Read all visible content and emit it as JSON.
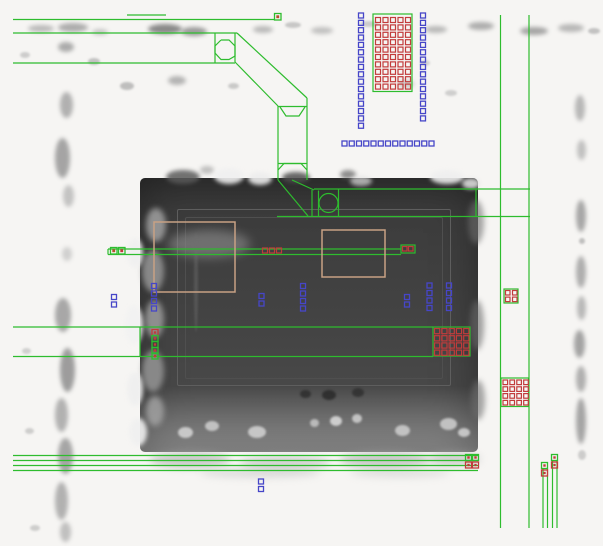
{
  "meta": {
    "description": "SEM micrograph of an IC region with CAD layout polygons overlaid (wires, contacts, vias, guide boxes)",
    "width": 603,
    "height": 546
  },
  "colors": {
    "background": "#f6f5f3",
    "wire_green": "#2ebc2e",
    "contact_blue": "#4646c8",
    "via_red": "#c23b3b",
    "marker_tan": "#c8a184",
    "marker_olive": "#9fae2f",
    "inner_red": "#b5512a",
    "sem_dark": "#3f3f3f"
  },
  "sem": {
    "dark_region": {
      "x": 140,
      "y": 178,
      "w": 338,
      "h": 274
    },
    "inner_rects": [
      {
        "x": 177,
        "y": 209,
        "w": 272,
        "h": 175,
        "c": "#5e5e5e"
      },
      {
        "x": 185,
        "y": 217,
        "w": 256,
        "h": 160,
        "c": "#4f4f4f"
      }
    ],
    "blobs": [
      [
        28,
        25,
        26,
        7,
        "#9a9a9a",
        2,
        0.65
      ],
      [
        58,
        23,
        30,
        9,
        "#8e8e8e",
        2,
        0.7
      ],
      [
        92,
        29,
        16,
        6,
        "#a5a5a5",
        2,
        0.6
      ],
      [
        148,
        24,
        34,
        10,
        "#6e6e6e",
        2,
        0.8
      ],
      [
        181,
        27,
        26,
        9,
        "#7d7d7d",
        2,
        0.75
      ],
      [
        253,
        26,
        20,
        7,
        "#9a9a9a",
        2,
        0.65
      ],
      [
        285,
        22,
        16,
        6,
        "#a8a8a8",
        1,
        0.6
      ],
      [
        311,
        27,
        22,
        7,
        "#9d9d9d",
        2,
        0.6
      ],
      [
        360,
        21,
        18,
        6,
        "#ababab",
        1,
        0.55
      ],
      [
        425,
        26,
        22,
        7,
        "#989898",
        2,
        0.65
      ],
      [
        468,
        22,
        26,
        8,
        "#8f8f8f",
        2,
        0.7
      ],
      [
        520,
        27,
        28,
        8,
        "#8a8a8a",
        2,
        0.75
      ],
      [
        558,
        24,
        26,
        8,
        "#979797",
        2,
        0.65
      ],
      [
        588,
        28,
        12,
        6,
        "#a0a0a0",
        1,
        0.6
      ],
      [
        58,
        42,
        16,
        10,
        "#8c8c8c",
        2,
        0.7
      ],
      [
        20,
        52,
        10,
        6,
        "#ababab",
        1,
        0.55
      ],
      [
        88,
        58,
        12,
        7,
        "#a0a0a0",
        1,
        0.6
      ],
      [
        60,
        92,
        13,
        26,
        "#949494",
        2,
        0.7
      ],
      [
        55,
        138,
        15,
        40,
        "#8a8a8a",
        2,
        0.75
      ],
      [
        63,
        185,
        11,
        22,
        "#a2a2a2",
        2,
        0.6
      ],
      [
        120,
        82,
        14,
        8,
        "#9a9a9a",
        1,
        0.6
      ],
      [
        168,
        76,
        18,
        9,
        "#909090",
        2,
        0.65
      ],
      [
        228,
        83,
        11,
        6,
        "#a5a5a5",
        1,
        0.55
      ],
      [
        200,
        166,
        14,
        8,
        "#9c9c9c",
        2,
        0.6
      ],
      [
        398,
        80,
        16,
        8,
        "#a3a3a3",
        2,
        0.55
      ],
      [
        420,
        60,
        10,
        6,
        "#aeaeae",
        1,
        0.5
      ],
      [
        445,
        90,
        12,
        6,
        "#a8a8a8",
        1,
        0.5
      ],
      [
        62,
        247,
        10,
        14,
        "#ababab",
        2,
        0.5
      ],
      [
        55,
        298,
        16,
        34,
        "#8e8e8e",
        2,
        0.75
      ],
      [
        60,
        348,
        15,
        44,
        "#878787",
        2,
        0.8
      ],
      [
        55,
        398,
        13,
        34,
        "#959595",
        2,
        0.7
      ],
      [
        58,
        438,
        15,
        36,
        "#8b8b8b",
        2,
        0.75
      ],
      [
        55,
        482,
        13,
        38,
        "#959595",
        2,
        0.7
      ],
      [
        60,
        522,
        11,
        20,
        "#9d9d9d",
        2,
        0.6
      ],
      [
        22,
        348,
        9,
        6,
        "#ababab",
        1,
        0.5
      ],
      [
        25,
        428,
        9,
        6,
        "#a5a5a5",
        1,
        0.5
      ],
      [
        30,
        525,
        10,
        6,
        "#a5a5a5",
        1,
        0.5
      ],
      [
        575,
        95,
        10,
        26,
        "#979797",
        2,
        0.65
      ],
      [
        577,
        140,
        9,
        20,
        "#9e9e9e",
        2,
        0.6
      ],
      [
        576,
        200,
        10,
        32,
        "#8d8d8d",
        2,
        0.75
      ],
      [
        579,
        238,
        6,
        6,
        "#9a9a9a",
        1,
        0.6
      ],
      [
        576,
        256,
        10,
        32,
        "#909090",
        2,
        0.7
      ],
      [
        577,
        296,
        9,
        24,
        "#989898",
        2,
        0.65
      ],
      [
        574,
        330,
        11,
        28,
        "#888888",
        2,
        0.75
      ],
      [
        576,
        366,
        10,
        26,
        "#929292",
        2,
        0.7
      ],
      [
        576,
        398,
        10,
        46,
        "#8a8a8a",
        2,
        0.75
      ],
      [
        578,
        450,
        8,
        10,
        "#a5a5a5",
        1,
        0.5
      ],
      [
        166,
        170,
        34,
        14,
        "#5a5a5a",
        2,
        0.85
      ],
      [
        282,
        172,
        28,
        11,
        "#4e4e4e",
        2,
        0.85
      ],
      [
        340,
        170,
        16,
        9,
        "#606060",
        2,
        0.7
      ],
      [
        214,
        168,
        30,
        16,
        "#f0f0f0",
        2,
        0.9
      ],
      [
        248,
        172,
        24,
        13,
        "#ededed",
        2,
        0.9
      ],
      [
        430,
        170,
        34,
        14,
        "#efefef",
        2,
        0.9
      ],
      [
        462,
        178,
        18,
        11,
        "#e6e6e6",
        2,
        0.85
      ],
      [
        350,
        176,
        22,
        10,
        "#e2e2e2",
        2,
        0.7
      ],
      [
        146,
        208,
        20,
        34,
        "#a8a8a8",
        3,
        0.8
      ],
      [
        142,
        250,
        22,
        42,
        "#9d9d9d",
        3,
        0.8
      ],
      [
        145,
        300,
        19,
        38,
        "#a3a3a3",
        3,
        0.8
      ],
      [
        142,
        350,
        22,
        42,
        "#9b9b9b",
        3,
        0.8
      ],
      [
        146,
        396,
        18,
        30,
        "#a6a6a6",
        3,
        0.8
      ],
      [
        127,
        238,
        16,
        30,
        "#f0f0f0",
        2,
        0.9
      ],
      [
        125,
        305,
        18,
        40,
        "#f2f2f2",
        2,
        0.9
      ],
      [
        127,
        372,
        16,
        34,
        "#efefef",
        2,
        0.9
      ],
      [
        129,
        418,
        18,
        28,
        "#f0f0f0",
        2,
        0.9
      ],
      [
        168,
        230,
        82,
        28,
        "#8a8a8a",
        5,
        0.65
      ],
      [
        194,
        232,
        4,
        100,
        "#6f6f6f",
        1,
        0.45
      ],
      [
        300,
        390,
        11,
        8,
        "#2c2c2c",
        1,
        0.8
      ],
      [
        322,
        390,
        14,
        10,
        "#2a2a2a",
        1,
        0.85
      ],
      [
        352,
        388,
        12,
        9,
        "#2e2e2e",
        1,
        0.8
      ],
      [
        330,
        416,
        12,
        10,
        "#dedede",
        1,
        0.85
      ],
      [
        352,
        414,
        10,
        9,
        "#d8d8d8",
        1,
        0.8
      ],
      [
        310,
        419,
        9,
        8,
        "#d2d2d2",
        1,
        0.75
      ],
      [
        205,
        421,
        14,
        10,
        "#d5d5d5",
        1,
        0.8
      ],
      [
        248,
        426,
        18,
        12,
        "#dadada",
        1,
        0.8
      ],
      [
        178,
        427,
        15,
        11,
        "#dddddd",
        1,
        0.8
      ],
      [
        395,
        425,
        15,
        11,
        "#d5d5d5",
        1,
        0.8
      ],
      [
        440,
        418,
        17,
        12,
        "#d0d0d0",
        1,
        0.85
      ],
      [
        458,
        428,
        12,
        9,
        "#dcdcdc",
        1,
        0.8
      ],
      [
        468,
        200,
        16,
        44,
        "#6e6e6e",
        3,
        0.6
      ],
      [
        470,
        300,
        14,
        50,
        "#6a6a6a",
        3,
        0.6
      ],
      [
        471,
        380,
        14,
        40,
        "#707070",
        3,
        0.6
      ],
      [
        150,
        452,
        80,
        16,
        "#a8a8a8",
        4,
        0.55
      ],
      [
        240,
        456,
        90,
        14,
        "#b0b0b0",
        4,
        0.5
      ],
      [
        340,
        452,
        90,
        16,
        "#a5a5a5",
        4,
        0.55
      ],
      [
        428,
        452,
        52,
        14,
        "#ababab",
        4,
        0.5
      ],
      [
        200,
        468,
        120,
        10,
        "#c0c0c0",
        4,
        0.45
      ],
      [
        350,
        468,
        100,
        10,
        "#c3c3c3",
        4,
        0.4
      ]
    ]
  },
  "overlay": {
    "green_lines": [
      [
        127,
        15,
        166,
        15
      ],
      [
        13,
        19.5,
        275,
        19.5
      ],
      [
        13,
        33,
        237,
        33
      ],
      [
        13,
        63,
        235,
        63
      ],
      [
        215,
        33,
        215,
        63
      ],
      [
        235,
        33,
        235,
        62
      ],
      [
        237,
        33,
        307,
        98
      ],
      [
        235,
        62,
        278,
        106
      ],
      [
        278,
        106,
        278,
        180
      ],
      [
        307,
        98,
        307,
        180
      ],
      [
        278,
        106.5,
        307,
        106.5
      ],
      [
        278,
        163.5,
        307,
        163.5
      ],
      [
        278,
        180,
        308,
        216
      ],
      [
        292,
        180,
        314,
        190
      ],
      [
        314,
        189,
        530,
        189
      ],
      [
        277,
        216.5,
        530,
        216.5
      ],
      [
        312,
        190,
        312,
        216.5
      ],
      [
        318.5,
        190.5,
        318.5,
        216.5
      ],
      [
        338.5,
        189.5,
        338.5,
        216.5
      ],
      [
        476,
        189,
        476,
        216.5
      ],
      [
        500.5,
        15,
        500.5,
        528
      ],
      [
        529,
        15,
        529,
        528
      ],
      [
        108,
        249,
        401,
        249
      ],
      [
        108,
        254.5,
        401,
        254.5
      ],
      [
        108,
        249,
        108,
        254.5
      ],
      [
        13,
        327,
        433,
        327
      ],
      [
        13,
        356.5,
        433,
        356.5
      ],
      [
        140,
        327,
        140,
        356.5
      ],
      [
        13,
        455.5,
        478,
        455.5
      ],
      [
        13,
        460.5,
        478,
        460.5
      ],
      [
        13,
        465.5,
        478,
        465.5
      ],
      [
        13,
        470.5,
        478,
        470.5
      ],
      [
        543,
        469,
        543,
        528
      ],
      [
        547.5,
        469,
        547.5,
        528
      ],
      [
        552.5,
        461,
        552.5,
        528
      ],
      [
        557,
        461,
        557,
        528
      ]
    ],
    "green_polylines": [
      "221,40 229,40 235,46 235,56 229,59.5 221,59.5 215,53 215,46 221,40",
      "280,107 286,116 299,116 305,107",
      "278,170 284,163.5 301,163.5 307,170"
    ],
    "green_circles": [
      {
        "cx": 328.5,
        "cy": 203,
        "r": 9.5
      }
    ],
    "green_rects": [
      [
        373,
        14,
        39,
        77.5
      ],
      [
        401,
        245,
        14,
        8
      ],
      [
        433,
        327,
        37,
        29
      ],
      [
        501,
        378,
        27.5,
        28.5
      ],
      [
        504,
        289,
        14,
        14
      ]
    ],
    "tan_rects": [
      [
        154,
        222,
        81,
        70
      ],
      [
        322,
        230,
        63,
        47
      ]
    ],
    "blue_square_sets": [
      {
        "x": 358.5,
        "y": 13,
        "step": 7.35,
        "count": 16,
        "dir": "v",
        "size": 5
      },
      {
        "x": 420.5,
        "y": 13,
        "step": 7.35,
        "count": 15,
        "dir": "v",
        "size": 5
      },
      {
        "x": 342,
        "y": 141,
        "step": 7.25,
        "count": 13,
        "dir": "h",
        "size": 5
      },
      {
        "x": 151.5,
        "y": 283.5,
        "step": 7.5,
        "count": 4,
        "dir": "v",
        "size": 5
      },
      {
        "x": 111.5,
        "y": 294.5,
        "step": 7.5,
        "count": 2,
        "dir": "v",
        "size": 5
      },
      {
        "x": 259,
        "y": 293.5,
        "step": 7.5,
        "count": 2,
        "dir": "v",
        "size": 5
      },
      {
        "x": 300.5,
        "y": 283.5,
        "step": 7.5,
        "count": 4,
        "dir": "v",
        "size": 5
      },
      {
        "x": 404.5,
        "y": 294.5,
        "step": 7.5,
        "count": 2,
        "dir": "v",
        "size": 5
      },
      {
        "x": 427,
        "y": 283,
        "step": 7.5,
        "count": 4,
        "dir": "v",
        "size": 5
      },
      {
        "x": 446.5,
        "y": 283,
        "step": 7.5,
        "count": 4,
        "dir": "v",
        "size": 5
      },
      {
        "x": 258.5,
        "y": 479,
        "step": 7.5,
        "count": 2,
        "dir": "v",
        "size": 5
      }
    ],
    "red_grids": [
      {
        "x": 375.5,
        "y": 17.5,
        "dx": 7.5,
        "dy": 7.4,
        "cols": 5,
        "rows": 10,
        "size": 5
      },
      {
        "x": 434.5,
        "y": 328.5,
        "dx": 7.3,
        "dy": 7.2,
        "cols": 5,
        "rows": 4,
        "size": 5.2
      },
      {
        "x": 503,
        "y": 380,
        "dx": 6.9,
        "dy": 6.8,
        "cols": 4,
        "rows": 4,
        "size": 4.6
      },
      {
        "x": 505.5,
        "y": 290.5,
        "dx": 7,
        "dy": 6.6,
        "cols": 2,
        "rows": 2,
        "size": 4.5
      },
      {
        "x": 262.5,
        "y": 248,
        "dx": 7,
        "dy": 0,
        "cols": 3,
        "rows": 1,
        "size": 5
      },
      {
        "x": 402.5,
        "y": 246.5,
        "dx": 6,
        "dy": 0,
        "cols": 2,
        "rows": 1,
        "size": 4.5
      }
    ],
    "special_squares": [
      {
        "x": 274.5,
        "y": 13.5,
        "size": 6.5,
        "stroke": "#2ebc2e",
        "inner": "#b5512a"
      },
      {
        "x": 110.5,
        "y": 247.5,
        "size": 6.5,
        "stroke": "#2ebc2e",
        "inner": "#b5512a"
      },
      {
        "x": 118.5,
        "y": 247.5,
        "size": 6.5,
        "stroke": "#2ebc2e",
        "inner": "#c23b3b"
      },
      {
        "x": 152,
        "y": 329.5,
        "size": 6,
        "stroke": "#c23b3b",
        "inner": "#c23b3b"
      },
      {
        "x": 152,
        "y": 335.5,
        "size": 6,
        "stroke": "#2ebc2e",
        "inner": "#c23b3b"
      },
      {
        "x": 152,
        "y": 341.5,
        "size": 6,
        "stroke": "#2ebc2e",
        "inner": "#c23b3b"
      },
      {
        "x": 152,
        "y": 347.5,
        "size": 6,
        "stroke": "#2ebc2e",
        "inner": "#c23b3b"
      },
      {
        "x": 152,
        "y": 353,
        "size": 6,
        "stroke": "#2ebc2e",
        "inner": "#c23b3b"
      },
      {
        "x": 465.5,
        "y": 454.5,
        "size": 6,
        "stroke": "#2ebc2e",
        "inner": "#c23b3b"
      },
      {
        "x": 472.5,
        "y": 454.5,
        "size": 6,
        "stroke": "#2ebc2e",
        "inner": "#c23b3b"
      },
      {
        "x": 465.5,
        "y": 462,
        "size": 6,
        "stroke": "#c23b3b",
        "inner": "#c23b3b"
      },
      {
        "x": 472.5,
        "y": 462,
        "size": 6,
        "stroke": "#c23b3b",
        "inner": "#c23b3b"
      },
      {
        "x": 541.5,
        "y": 462.5,
        "size": 6,
        "stroke": "#2ebc2e",
        "inner": "#c23b3b"
      },
      {
        "x": 541.5,
        "y": 470,
        "size": 6,
        "stroke": "#c23b3b",
        "inner": "#c23b3b"
      },
      {
        "x": 551.5,
        "y": 454.5,
        "size": 6,
        "stroke": "#2ebc2e",
        "inner": "#c23b3b"
      },
      {
        "x": 551.5,
        "y": 462,
        "size": 6,
        "stroke": "#c23b3b",
        "inner": "#c23b3b"
      }
    ]
  }
}
